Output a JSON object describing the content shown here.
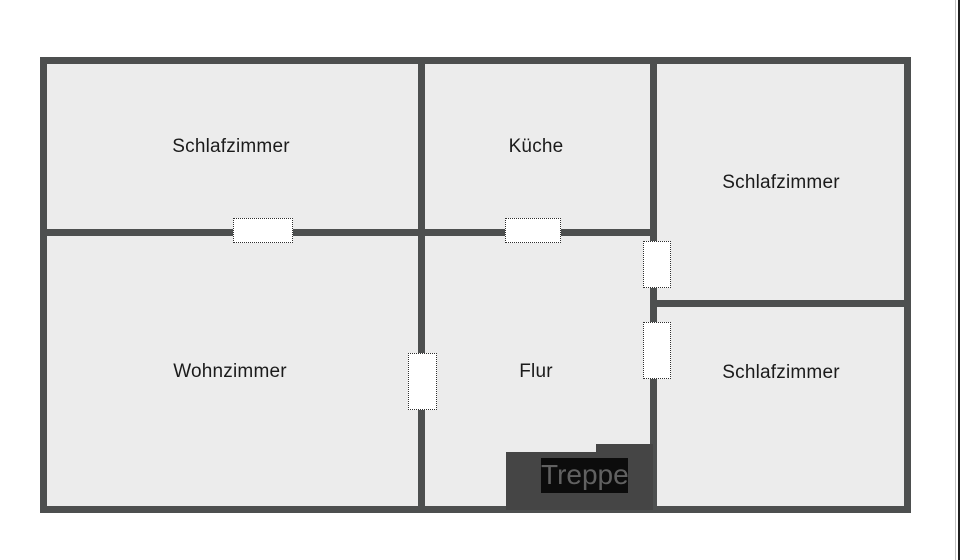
{
  "plan": {
    "rooms": [
      {
        "id": "schlafzimmer-top-left",
        "label": "Schlafzimmer"
      },
      {
        "id": "kueche",
        "label": "Küche"
      },
      {
        "id": "schlafzimmer-right",
        "label": "Schlafzimmer"
      },
      {
        "id": "wohnzimmer",
        "label": "Wohnzimmer"
      },
      {
        "id": "flur",
        "label": "Flur"
      },
      {
        "id": "schlafzimmer-bottom-right",
        "label": "Schlafzimmer"
      }
    ],
    "stairs": {
      "label": "Treppe"
    },
    "colors": {
      "wall": "#4d4f4f",
      "floor": "#ececec",
      "background": "#ffffff",
      "stairs": "#454545",
      "stairs_label_bg": "#0c0c0c",
      "stairs_label_text": "#616161",
      "room_label_text": "#1b1b1b",
      "door_dot": "#2f2f2f",
      "edge_line_light": "#c4c4c4",
      "edge_line_dark": "#1f1f1f"
    }
  }
}
